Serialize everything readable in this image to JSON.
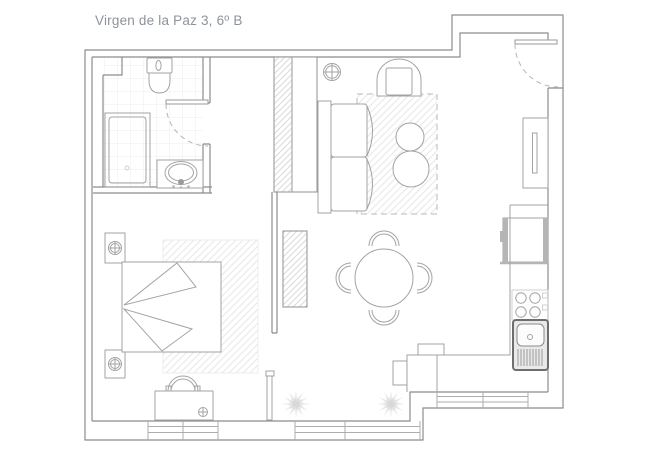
{
  "title": "Virgen de la Paz 3, 6º B",
  "colors": {
    "background": "#ffffff",
    "wall_line": "#8c8c8c",
    "furniture_line": "#a3a3a3",
    "fixture_dark": "#6e6e6e",
    "tile_line": "#ececec",
    "hatch_line": "#e7e7e7",
    "plant_fill": "#e0e0e0",
    "title_text": "#8e939a"
  },
  "floorplan": {
    "drawing_type": "apartment-floor-plan",
    "rooms": [
      {
        "name": "bathroom",
        "position": "top-left",
        "fixtures": [
          "toilet",
          "shower-tray",
          "washbasin",
          "vanity-counter",
          "door-swing",
          "tiled-floor"
        ]
      },
      {
        "name": "bedroom",
        "position": "bottom-left",
        "fixtures": [
          "double-bed",
          "nightstand-top",
          "nightstand-bottom",
          "bedside-lamp-top",
          "bedside-lamp-bottom",
          "area-rug",
          "desk",
          "desk-chair",
          "desk-lamp",
          "open-door-leaf"
        ]
      },
      {
        "name": "living-room",
        "position": "top-right",
        "fixtures": [
          "sofa",
          "armchair",
          "coffee-table-small",
          "coffee-table-large",
          "area-rug",
          "ceiling-light"
        ]
      },
      {
        "name": "dining-area",
        "position": "center",
        "fixtures": [
          "round-table",
          "chair-top",
          "chair-bottom",
          "chair-left",
          "chair-right"
        ]
      },
      {
        "name": "kitchen",
        "position": "right",
        "fixtures": [
          "tall-cabinet",
          "oven",
          "worktop",
          "hob-4-burners",
          "sink-with-drainer",
          "peninsula-counter"
        ]
      },
      {
        "name": "entrance-hall",
        "position": "top-right-corner",
        "fixtures": [
          "entry-door",
          "door-swing-arc"
        ]
      }
    ],
    "windows": [
      "window-bottom-left",
      "window-bottom-center",
      "window-bottom-right"
    ],
    "decorations": [
      "plant-left",
      "plant-right",
      "structural-shaft-column"
    ]
  }
}
